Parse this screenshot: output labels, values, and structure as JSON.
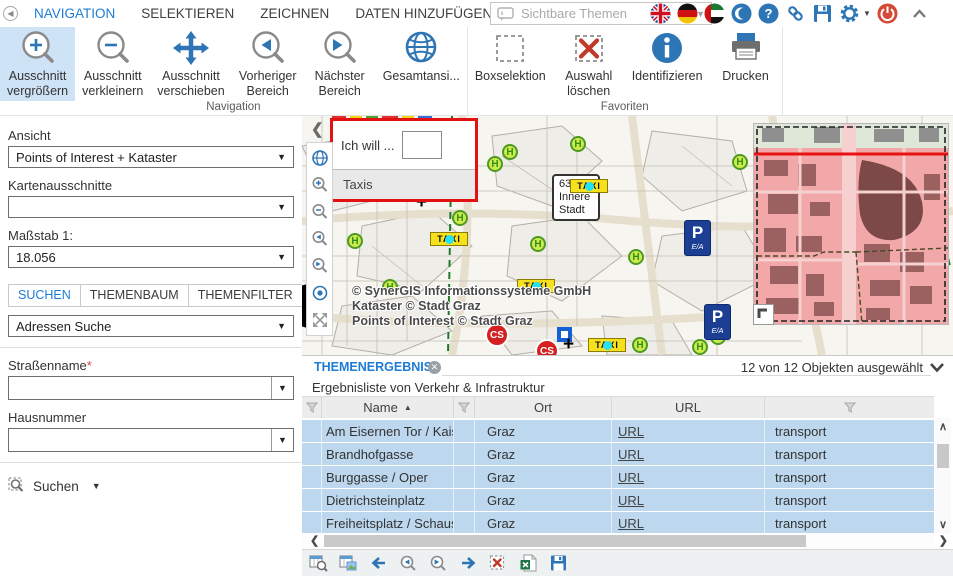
{
  "titlebar": {
    "menu_items": [
      {
        "label": "NAVIGATION",
        "active": true
      },
      {
        "label": "SELEKTIEREN",
        "active": false
      },
      {
        "label": "ZEICHNEN",
        "active": false
      },
      {
        "label": "DATEN HINZUFÜGEN",
        "active": false
      },
      {
        "label": "AUSGABE",
        "active": false
      }
    ],
    "themes_dropdown_placeholder": "Sichtbare Themen",
    "icon_names": [
      "uk-flag-icon",
      "german-flag-icon",
      "uae-flag-icon",
      "crescent-icon",
      "help-icon",
      "link-icon",
      "save-icon",
      "settings-gear-icon",
      "power-icon",
      "collapse-ribbon-icon"
    ]
  },
  "ribbon": {
    "groups": [
      {
        "label": "Navigation"
      },
      {
        "label": "Favoriten"
      }
    ],
    "buttons": [
      {
        "line1": "Ausschnitt",
        "line2": "vergrößern",
        "icon": "zoom-in-magnifier"
      },
      {
        "line1": "Ausschnitt",
        "line2": "verkleinern",
        "icon": "zoom-out-magnifier"
      },
      {
        "line1": "Ausschnitt",
        "line2": "verschieben",
        "icon": "pan-arrows"
      },
      {
        "line1": "Vorheriger",
        "line2": "Bereich",
        "icon": "previous-extent-magnifier"
      },
      {
        "line1": "Nächster",
        "line2": "Bereich",
        "icon": "next-extent-magnifier"
      },
      {
        "line1": "Gesamtansi...",
        "line2": "",
        "icon": "globe"
      },
      {
        "line1": "Boxselektion",
        "line2": "",
        "icon": "box-select"
      },
      {
        "line1": "Auswahl",
        "line2": "löschen",
        "icon": "clear-selection"
      },
      {
        "line1": "Identifizieren",
        "line2": "",
        "icon": "identify-info"
      },
      {
        "line1": "Drucken",
        "line2": "",
        "icon": "printer"
      }
    ]
  },
  "sidebar": {
    "ansicht_label": "Ansicht",
    "ansicht_value": "Points of Interest + Kataster",
    "kartenausschnitte_label": "Kartenausschnitte",
    "kartenausschnitte_value": "",
    "massstab_label": "Maßstab 1:",
    "massstab_value": "18.056",
    "tabs": [
      {
        "label": "SUCHEN",
        "active": true
      },
      {
        "label": "THEMENBAUM",
        "active": false
      },
      {
        "label": "THEMENFILTER",
        "active": false
      }
    ],
    "search_type_value": "Adressen Suche",
    "strassenname_label": "Straßenname",
    "required_marker": "*",
    "hausnummer_label": "Hausnummer",
    "suchen_label": "Suchen"
  },
  "map": {
    "popup_title": "Ich will ...",
    "popup_option": "Taxis",
    "copyright_line1": "© SynerGIS Informationssysteme GmbH",
    "copyright_line2": "Kataster © Stadt Graz",
    "copyright_line3": "Points of Interest © Stadt Graz",
    "district_line1": "6310.2",
    "district_line2": "Innere",
    "district_line3": "Stadt",
    "taxi_label": "TAXI",
    "h_stop_label": "H",
    "parking_label": "P",
    "parking_sub_label": "E/A",
    "carsharing_label": "CS"
  },
  "results": {
    "tab_label": "THEMENERGEBNIS",
    "selection_status": "12 von 12 Objekten ausgewählt",
    "subtitle": "Ergebnisliste von Verkehr & Infrastruktur",
    "col_name": "Name",
    "col_ort": "Ort",
    "col_url": "URL",
    "rows": [
      {
        "name": "Am Eisernen Tor / Kaiserfeldgasse",
        "ort": "Graz",
        "url": "URL",
        "extra": "transport"
      },
      {
        "name": "Brandhofgasse",
        "ort": "Graz",
        "url": "URL",
        "extra": "transport"
      },
      {
        "name": "Burggasse / Oper",
        "ort": "Graz",
        "url": "URL",
        "extra": "transport"
      },
      {
        "name": "Dietrichsteinplatz",
        "ort": "Graz",
        "url": "URL",
        "extra": "transport"
      },
      {
        "name": "Freiheitsplatz / Schauspielhaus",
        "ort": "Graz",
        "url": "URL",
        "extra": "transport"
      }
    ]
  },
  "colors": {
    "accent_blue": "#1c7cd6",
    "icon_blue": "#2e75b6",
    "active_button_bg": "#cfe3f7",
    "row_selection_blue": "#bcd7ee",
    "popup_border_red": "#e31212",
    "overview_pink": "#f2b4b4"
  }
}
